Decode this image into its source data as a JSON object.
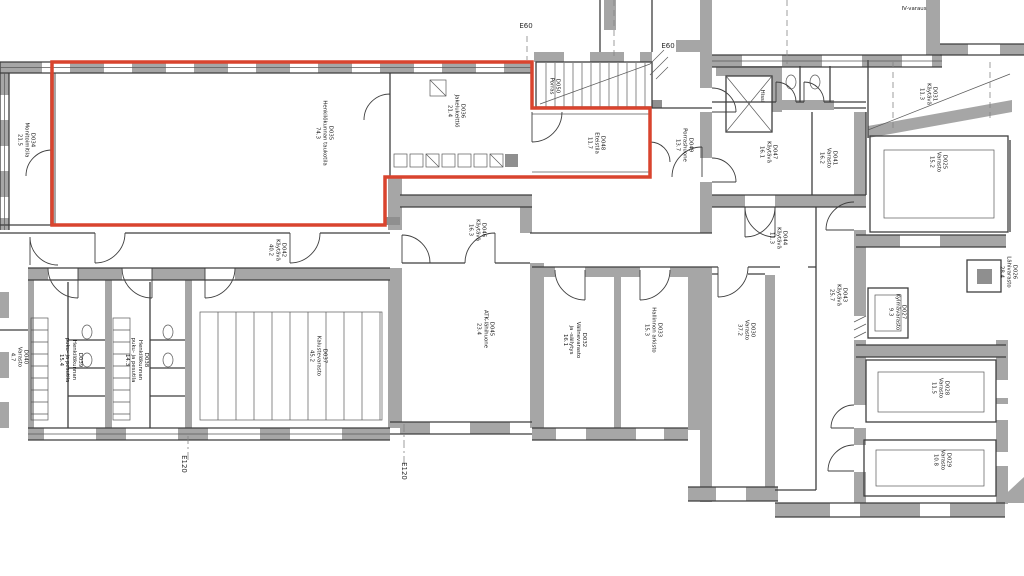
{
  "colors": {
    "wall": "#a6a6a6",
    "wall_dark": "#8f8f8f",
    "line": "#3e3e3e",
    "highlight": "#d9442e",
    "background": "#ffffff"
  },
  "highlight_outline": {
    "color_hex": "#d9442e",
    "encloses_room_ids": [
      "D035",
      "D036",
      "D048"
    ]
  },
  "rooms": [
    {
      "id": "D034",
      "name": "Monitoimitila",
      "area": "21.5",
      "text": "D034\nMonitoimitila\n21.5"
    },
    {
      "id": "D035",
      "name": "Henkilökunnan taukotila",
      "area": "74.3",
      "text": "D035\nHenkilökunnan taukotila\n74.3"
    },
    {
      "id": "D036",
      "name": "Jakelukeittiö",
      "area": "21.4",
      "text": "D036\nJakelukeittiö\n21.4"
    },
    {
      "id": "D050",
      "name": "Porras",
      "area": "",
      "text": "D050\nPorras"
    },
    {
      "id": "D048",
      "name": "Eteistila",
      "area": "11.7",
      "text": "D048\nEteistila\n11.7"
    },
    {
      "id": "D049",
      "name": "Porrashuone",
      "area": "13.7",
      "text": "D049\nPorrashuone\n13.7"
    },
    {
      "id": "",
      "name": "Hissi",
      "area": "",
      "text": "Hissi"
    },
    {
      "id": "D047",
      "name": "Käytävä",
      "area": "16.1",
      "text": "D047\nKäytävä\n16.1"
    },
    {
      "id": "D041",
      "name": "Varasto",
      "area": "16.2",
      "text": "D041\nVarasto\n16.2"
    },
    {
      "id": "D031",
      "name": "Käytävä",
      "area": "11.3",
      "text": "D031\nKäytävä\n11.3"
    },
    {
      "id": "D025",
      "name": "Varasto",
      "area": "15.2",
      "text": "D025\nVarasto\n15.2"
    },
    {
      "id": "D026",
      "name": "Lähivarasto",
      "area": "28.4",
      "text": "D026\nLähivarasto\n28.4"
    },
    {
      "id": "D027",
      "name": "Kylmävarasto",
      "area": "9.3",
      "text": "D027\nKylmävarasto\n9.3"
    },
    {
      "id": "D028",
      "name": "Varasto",
      "area": "11.5",
      "text": "D028\nVarasto\n11.5"
    },
    {
      "id": "D029",
      "name": "Varasto",
      "area": "10.8",
      "text": "D029\nVarasto\n10.8"
    },
    {
      "id": "D046",
      "name": "Käytävä",
      "area": "16.3",
      "text": "D046\nKäytävä\n16.3"
    },
    {
      "id": "D045",
      "name": "ATK-lähihuone",
      "area": "23.4",
      "text": "D045\nATK-lähihuone\n23.4"
    },
    {
      "id": "D032",
      "name": "Välinevarasto ja -säilytys",
      "area": "16.1",
      "text": "D032\nVälinevarasto\nja -säilytys\n16.1"
    },
    {
      "id": "D033",
      "name": "Hallinnon arkisto",
      "area": "15.3",
      "text": "D033\nHallinnon arkisto\n15.3"
    },
    {
      "id": "D030",
      "name": "Varasto",
      "area": "37.2",
      "text": "D030\nVarasto\n37.2"
    },
    {
      "id": "D044",
      "name": "Käytävä",
      "area": "11.3",
      "text": "D044\nKäytävä\n11.3"
    },
    {
      "id": "D043",
      "name": "Käytävä",
      "area": "25.7",
      "text": "D043\nKäytävä\n25.7"
    },
    {
      "id": "D042",
      "name": "Käytävä",
      "area": "40.2",
      "text": "D042\nKäytävä\n40.2"
    },
    {
      "id": "D040",
      "name": "Varasto",
      "area": "4.7",
      "text": "D040\nVarasto\n4.7"
    },
    {
      "id": "D039",
      "name": "Henkilökunnan puku- ja pesutila",
      "area": "15.4",
      "text": "D039\nHenkilökunnan\npuku- ja pesutila\n15.4"
    },
    {
      "id": "D038",
      "name": "Henkilökunnan puku- ja pesutila",
      "area": "14.3",
      "text": "D038\nHenkilökunnan\npuku- ja pesutila\n14.3"
    },
    {
      "id": "D037",
      "name": "Kalustevarasto",
      "area": "45.2",
      "text": "D037\nKalustevarasto\n45.2"
    },
    {
      "id": "",
      "name": "IV-varaus",
      "area": "",
      "text": "IV-varaus"
    }
  ],
  "markers": [
    {
      "text": "E60"
    },
    {
      "text": "E60"
    },
    {
      "text": "E120"
    },
    {
      "text": "E120"
    }
  ]
}
